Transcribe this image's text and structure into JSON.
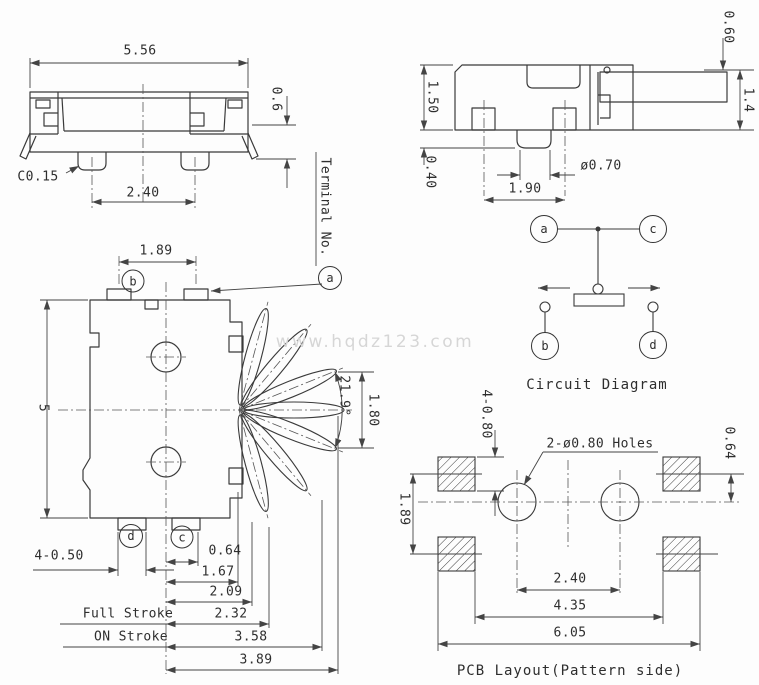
{
  "watermark": "www.hqdz123.com",
  "terminals": {
    "a": "a",
    "b": "b",
    "c": "c",
    "d": "d"
  },
  "front_view": {
    "dim_width": "5.56",
    "dim_step_height": "0.6",
    "chamfer": "C0.15",
    "dim_leg_pitch": "2.40"
  },
  "side_view": {
    "dim_body_height": "1.50",
    "dim_leg_height": "0.40",
    "dim_boss_dia": "ø0.70",
    "dim_leg_pitch": "1.90",
    "dim_lever_offset": "0.60",
    "dim_lever_height": "1.4"
  },
  "top_view": {
    "terminal_label": "Terminal No.",
    "dim_terminal_pitch": "1.89",
    "dim_body_length": "5",
    "dim_angle": "21.9°",
    "dim_travel": "1.80",
    "dim_terminal_width": "4-0.50",
    "full_stroke_label": "Full Stroke",
    "on_stroke_label": "ON Stroke",
    "dim_stack": [
      "0.64",
      "1.67",
      "2.09",
      "2.32",
      "3.58",
      "3.89"
    ]
  },
  "circuit_diagram": {
    "caption": "Circuit Diagram"
  },
  "pcb_layout": {
    "caption": "PCB Layout(Pattern side)",
    "dim_pad_width": "4-0.80",
    "dim_pad_pitch": "1.89",
    "dim_offset": "0.64",
    "holes_label": "2-ø0.80 Holes",
    "dim_hole_pitch": "2.40",
    "dim_pad_inner": "4.35",
    "dim_pad_outer": "6.05"
  }
}
